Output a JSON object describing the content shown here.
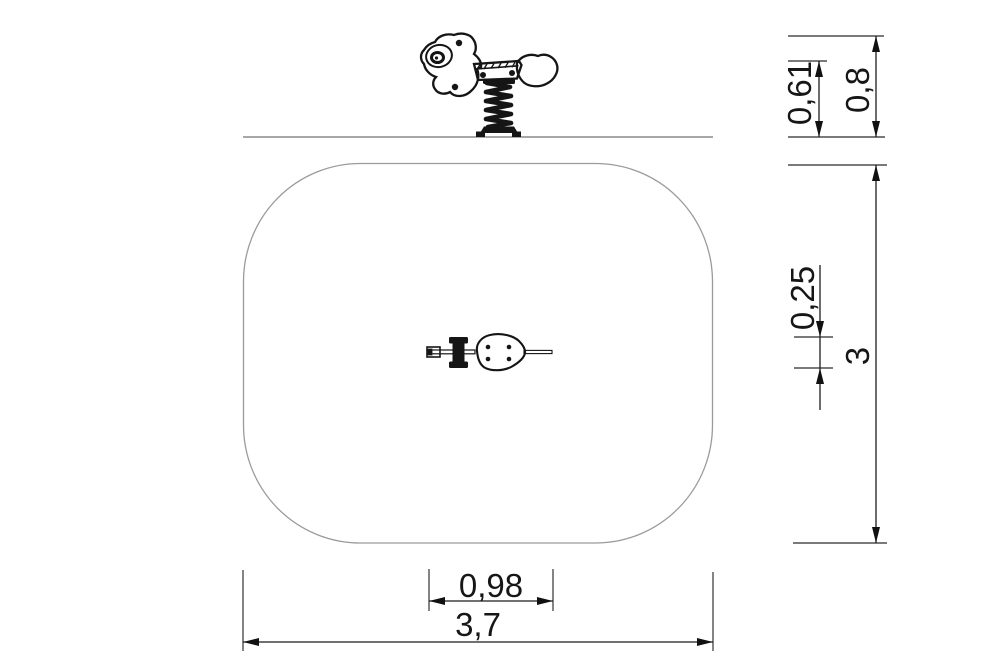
{
  "dimensions": {
    "seat_height": {
      "label": "0,61"
    },
    "total_height": {
      "label": "0,8"
    },
    "rider_width": {
      "label": "0,25"
    },
    "zone_depth": {
      "label": "3"
    },
    "rider_length": {
      "label": "0,98"
    },
    "zone_width": {
      "label": "3,7"
    }
  },
  "colors": {
    "ink": "#161616",
    "dimension_line": "#1c1c1c",
    "zone_outline": "#9b9b9b",
    "ground_line": "#8c8c8c",
    "background": "#ffffff"
  }
}
